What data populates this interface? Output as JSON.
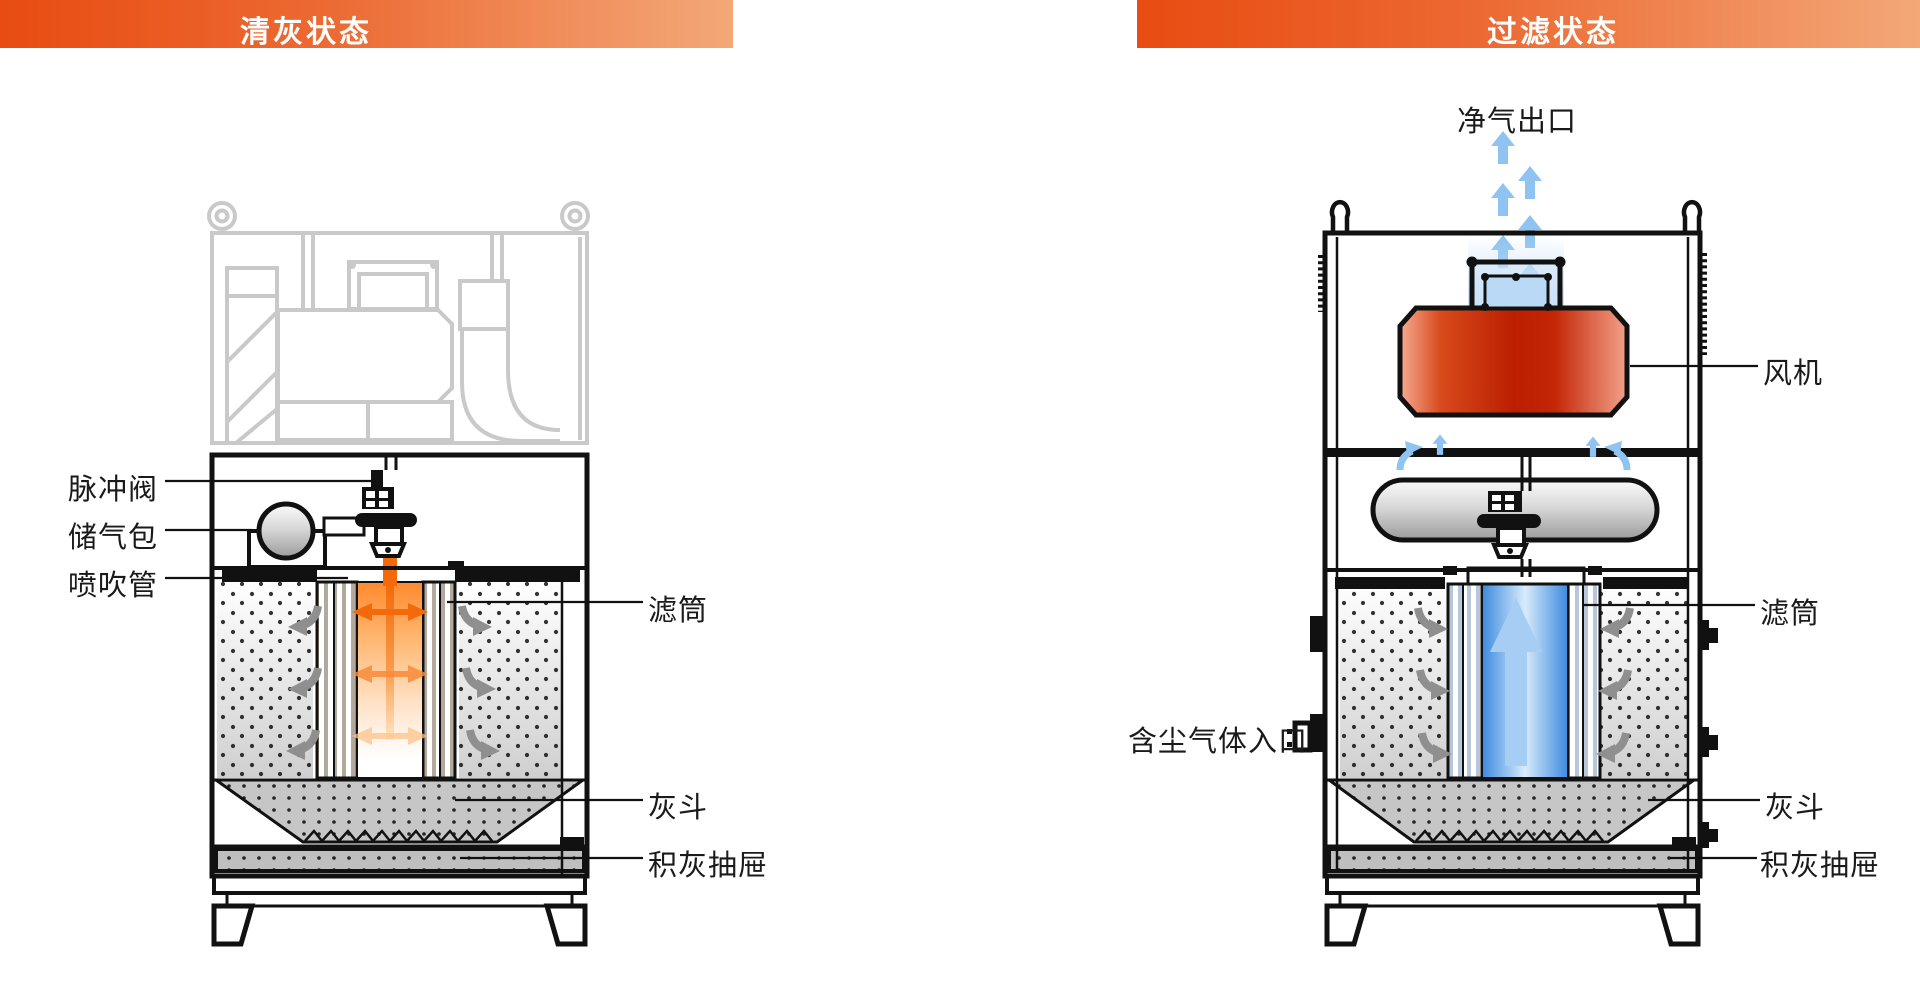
{
  "colors": {
    "banner_orange_start": "#e84c12",
    "banner_orange_end": "#f3a878",
    "fan_red": "#bb1f00",
    "airflow_blue": "#8fc3f1",
    "pulse_jet_orange": "#f4690a",
    "ghost_gray": "#c9c9c9",
    "label_text": "#1a1a1a"
  },
  "left_panel": {
    "banner": "清灰状态",
    "labels": {
      "pulse_valve": "脉冲阀",
      "air_reservoir": "储气包",
      "blow_pipe": "喷吹管",
      "filter_cartridge": "滤筒",
      "ash_hopper": "灰斗",
      "dust_drawer": "积灰抽屉"
    }
  },
  "right_panel": {
    "banner": "过滤状态",
    "labels": {
      "clean_air_outlet": "净气出口",
      "fan": "风机",
      "filter_cartridge": "滤筒",
      "dusty_gas_inlet": "含尘气体入口",
      "ash_hopper": "灰斗",
      "dust_drawer": "积灰抽屉"
    }
  }
}
